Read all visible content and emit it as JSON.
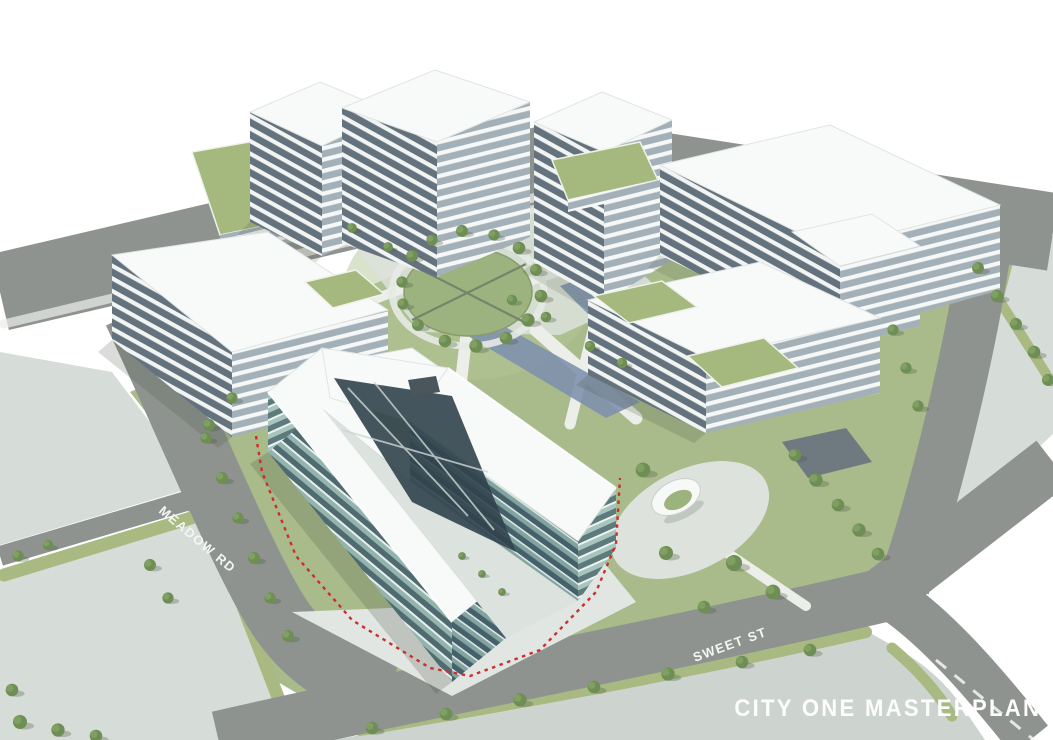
{
  "scene": {
    "title": "CITY ONE MASTERPLAN",
    "street_labels": {
      "meadow_road": "MEADOW RD",
      "sweet_street": "SWEET ST"
    }
  },
  "palette": {
    "background": "#ffffff",
    "road_gray": "#8e938f",
    "parcel_light": "#d6dcd7",
    "grass_green": "#a9bb8b",
    "green_roof": "#a5b97e",
    "tree_green": "#6f8e55",
    "building_white": "#f8faf9",
    "facade_shadow_gray": "#64727e",
    "glass_teal": "#8fb3ad",
    "water_feature_blue": "#8091ad",
    "site_boundary_red": "#c92f2f",
    "label_white": "#f4f6f3"
  }
}
